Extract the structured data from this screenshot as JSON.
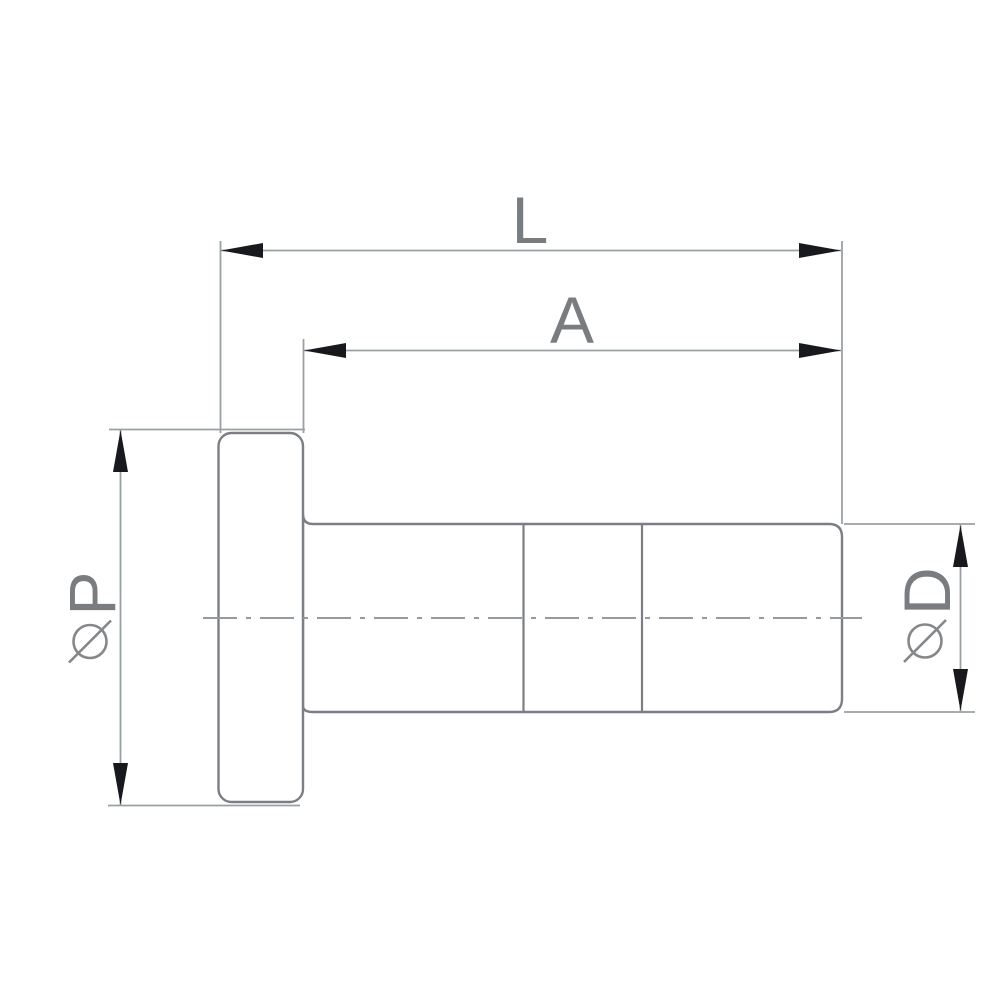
{
  "drawing": {
    "kind": "technical dimension drawing",
    "view": "side view of flanged cylindrical fitting",
    "background_color": "#ffffff",
    "colors": {
      "part_outline": "#7b7e82",
      "dimension_lines": "#9aa0a4",
      "centerline": "#949a9e",
      "arrowheads": "#17191c",
      "label_text": "#7a7d80"
    },
    "dimensions": {
      "overall_length": {
        "label": "L"
      },
      "body_length": {
        "label": "A"
      },
      "flange_diameter": {
        "label": "ØP",
        "letter": "P",
        "symbol": "diameter"
      },
      "body_diameter": {
        "label": "ØD",
        "letter": "D",
        "symbol": "diameter"
      }
    }
  }
}
